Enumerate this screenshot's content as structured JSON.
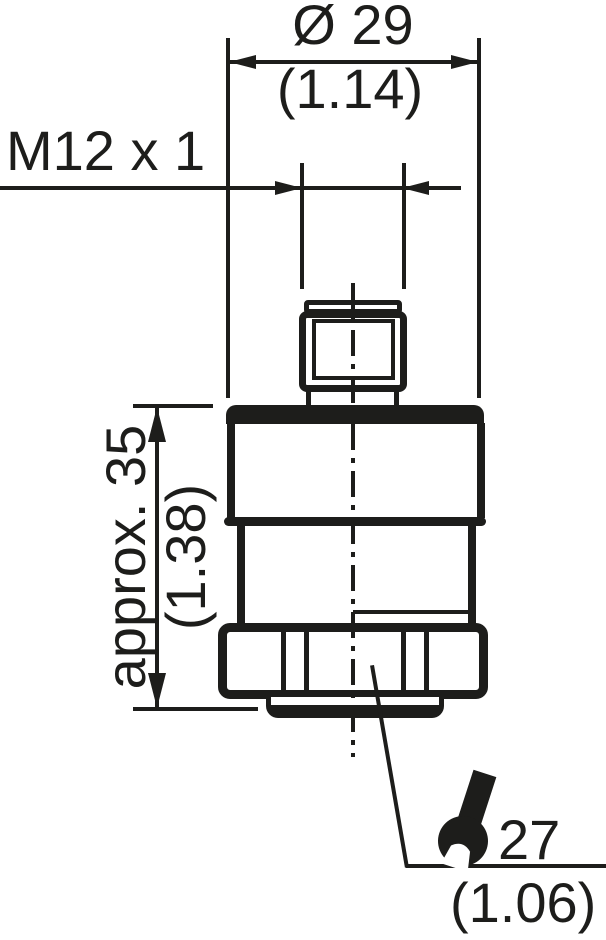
{
  "drawing": {
    "background": "#ffffff",
    "line_color": "#1d1d1b"
  },
  "dimensions": {
    "diameter": {
      "metric": "Ø 29",
      "imperial": "(1.14)"
    },
    "thread": {
      "label": "M12 x 1"
    },
    "height": {
      "metric": "approx. 35",
      "imperial": "(1.38)"
    },
    "wrench_flats": {
      "metric": "27",
      "imperial": "(1.06)"
    }
  },
  "icons": {
    "wrench": "wrench-icon"
  }
}
